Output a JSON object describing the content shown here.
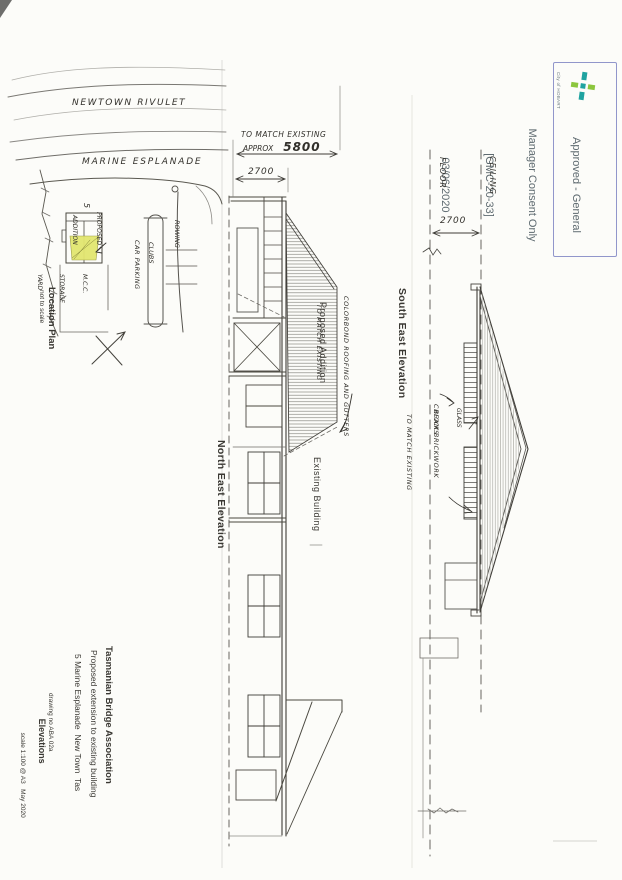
{
  "stamp": {
    "org": "City of HOBART",
    "line1": "Approved - General",
    "line2": "Manager Consent Only",
    "line3": "[GMC-20-33]",
    "line4": "03/06/2020"
  },
  "location_plan": {
    "river": "NEWTOWN RIVULET",
    "road": "MARINE ESPLANADE",
    "proposed_1": "PROPOSED",
    "proposed_2": "ADDITION",
    "storage_1": "M.C.C.",
    "storage_2": "STORAGE",
    "storage_3": "YARD",
    "car_parking": "CAR PARKING",
    "rowing_1": "ROWING",
    "rowing_2": "CLUBS",
    "site_number": "5",
    "title": "Location Plan",
    "subtitle": "not to scale"
  },
  "ne_elevation": {
    "title": "North East Elevation",
    "dim_note_1": "TO MATCH EXISTING",
    "dim_note_2a": "APPROX",
    "dim_note_2b": "5800",
    "dim_2700": "2700",
    "label_addition": "Proposed Addition",
    "label_existing": "Existing Building",
    "note_roof_1": "COLORBOND ROOFING AND GUTTERS",
    "note_roof_2": "TO MATCH EXISTING"
  },
  "se_elevation": {
    "title": "South East Elevation",
    "label_floor": "FLOOR",
    "label_ceiling": "CEILING",
    "dim_2700": "2700",
    "note_glass_1": "GLASS",
    "note_glass_2": "BLOCKS",
    "note_brick_1": "CREAM BRICKWORK",
    "note_brick_2": "TO MATCH EXISTING"
  },
  "title_block": {
    "org": "Tasmanian Bridge Association",
    "project": "Proposed extension to existing building",
    "address": "5 Marine Esplanade  New Town  Tas",
    "sheet": "Elevations",
    "scale": "scale 1:100 @ A3   May 2020",
    "drawing_no": "drawing no ABA 02a"
  },
  "colors": {
    "highlight": "#e2e66f",
    "stamp_border": "#9196cb",
    "stamp_text": "#5e6a70",
    "logo_teal": "#1fa3a0",
    "logo_green": "#8cc63e",
    "ink": "#3f3d38"
  }
}
